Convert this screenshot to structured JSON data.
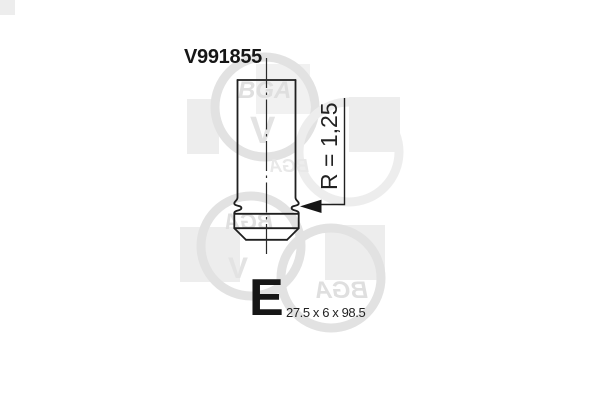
{
  "part": {
    "number": "V991855"
  },
  "drawing": {
    "radius_label": "R = 1,25",
    "type_letter": "E",
    "dimensions_label": "27.5 x 6 x 98.5"
  },
  "watermark": {
    "logo_text": "BGA",
    "wrench_glyph": "V"
  },
  "colors": {
    "line": "#1f1f1f",
    "text": "#161616",
    "watermark_square": "#ededed",
    "watermark_ring": "#e2e2e2",
    "watermark_text": "#dfdfdf",
    "background": "#ffffff"
  }
}
